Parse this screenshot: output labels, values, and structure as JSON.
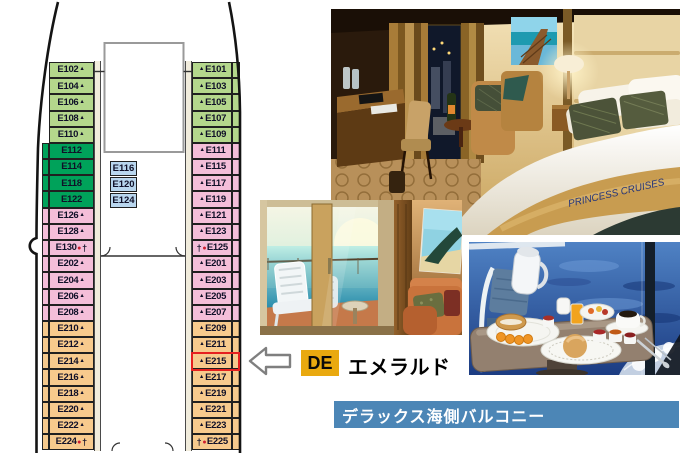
{
  "deck_plan": {
    "middle": [
      "E116",
      "E120",
      "E124"
    ],
    "left": [
      {
        "n": "E102",
        "c": "g1",
        "suf": [
          "tri"
        ]
      },
      {
        "n": "E104",
        "c": "g1",
        "suf": [
          "tri"
        ]
      },
      {
        "n": "E106",
        "c": "g1",
        "suf": [
          "tri"
        ]
      },
      {
        "n": "E108",
        "c": "g1",
        "suf": [
          "tri"
        ]
      },
      {
        "n": "E110",
        "c": "g1",
        "suf": [
          "tri"
        ]
      },
      {
        "n": "E112",
        "c": "g2"
      },
      {
        "n": "E114",
        "c": "g2"
      },
      {
        "n": "E118",
        "c": "g2"
      },
      {
        "n": "E122",
        "c": "g2"
      },
      {
        "n": "E126",
        "c": "pk",
        "suf": [
          "tri"
        ]
      },
      {
        "n": "E128",
        "c": "pk",
        "suf": [
          "tri"
        ]
      },
      {
        "n": "E130",
        "c": "pk",
        "suf": [
          "dot",
          "dag"
        ]
      },
      {
        "n": "E202",
        "c": "pk",
        "suf": [
          "tri"
        ]
      },
      {
        "n": "E204",
        "c": "pk",
        "suf": [
          "tri"
        ]
      },
      {
        "n": "E206",
        "c": "pk",
        "suf": [
          "tri"
        ]
      },
      {
        "n": "E208",
        "c": "pk",
        "suf": [
          "tri"
        ]
      },
      {
        "n": "E210",
        "c": "or",
        "suf": [
          "tri"
        ]
      },
      {
        "n": "E212",
        "c": "or",
        "suf": [
          "tri"
        ]
      },
      {
        "n": "E214",
        "c": "or",
        "suf": [
          "tri"
        ]
      },
      {
        "n": "E216",
        "c": "or",
        "suf": [
          "tri"
        ]
      },
      {
        "n": "E218",
        "c": "or",
        "suf": [
          "tri"
        ]
      },
      {
        "n": "E220",
        "c": "or",
        "suf": [
          "tri"
        ]
      },
      {
        "n": "E222",
        "c": "or",
        "suf": [
          "tri"
        ]
      },
      {
        "n": "E224",
        "c": "or",
        "suf": [
          "dot",
          "dag"
        ]
      }
    ],
    "right": [
      {
        "n": "E101",
        "c": "g1",
        "pre": [
          "tri"
        ]
      },
      {
        "n": "E103",
        "c": "g1",
        "pre": [
          "tri"
        ]
      },
      {
        "n": "E105",
        "c": "g1",
        "pre": [
          "tri"
        ]
      },
      {
        "n": "E107",
        "c": "g1",
        "pre": [
          "tri"
        ]
      },
      {
        "n": "E109",
        "c": "g1",
        "pre": [
          "tri"
        ]
      },
      {
        "n": "E111",
        "c": "pk",
        "pre": [
          "tri"
        ]
      },
      {
        "n": "E115",
        "c": "pk",
        "pre": [
          "tri"
        ]
      },
      {
        "n": "E117",
        "c": "pk",
        "pre": [
          "tri"
        ]
      },
      {
        "n": "E119",
        "c": "pk",
        "pre": [
          "tri"
        ]
      },
      {
        "n": "E121",
        "c": "pk",
        "pre": [
          "tri"
        ]
      },
      {
        "n": "E123",
        "c": "pk",
        "pre": [
          "tri"
        ]
      },
      {
        "n": "E125",
        "c": "pk",
        "pre": [
          "dag",
          "dot"
        ]
      },
      {
        "n": "E201",
        "c": "pk",
        "pre": [
          "tri"
        ]
      },
      {
        "n": "E203",
        "c": "pk",
        "pre": [
          "tri"
        ]
      },
      {
        "n": "E205",
        "c": "pk",
        "pre": [
          "tri"
        ]
      },
      {
        "n": "E207",
        "c": "pk",
        "pre": [
          "tri"
        ]
      },
      {
        "n": "E209",
        "c": "or",
        "pre": [
          "tri"
        ]
      },
      {
        "n": "E211",
        "c": "or",
        "pre": [
          "tri"
        ]
      },
      {
        "n": "E215",
        "c": "or",
        "pre": [
          "tri"
        ],
        "hl": true
      },
      {
        "n": "E217",
        "c": "or",
        "pre": [
          "tri"
        ]
      },
      {
        "n": "E219",
        "c": "or",
        "pre": [
          "tri"
        ]
      },
      {
        "n": "E221",
        "c": "or",
        "pre": [
          "tri"
        ]
      },
      {
        "n": "E223",
        "c": "or",
        "pre": [
          "tri"
        ]
      },
      {
        "n": "E225",
        "c": "or",
        "pre": [
          "dag",
          "dot"
        ]
      }
    ],
    "highlighted_cabin": "E215"
  },
  "legend": {
    "code": "DE",
    "name": "エメラルド"
  },
  "banner": {
    "text": "デラックス海側バルコニー"
  },
  "photos": {
    "cabin_interior": {
      "bed_runner_text": "PRINCESS CRUISES"
    }
  },
  "colors": {
    "cabin": {
      "g1": "#b4d78c",
      "g2": "#00a25a",
      "bl": "#b9d6ee",
      "pk": "#f4bed9",
      "or": "#f7ca8d"
    },
    "highlight_red": "#e62020",
    "legend_badge_gold": "#e9a90f",
    "banner_blue": "#4c86b6",
    "arrow_gray": "#7f7f7f"
  }
}
